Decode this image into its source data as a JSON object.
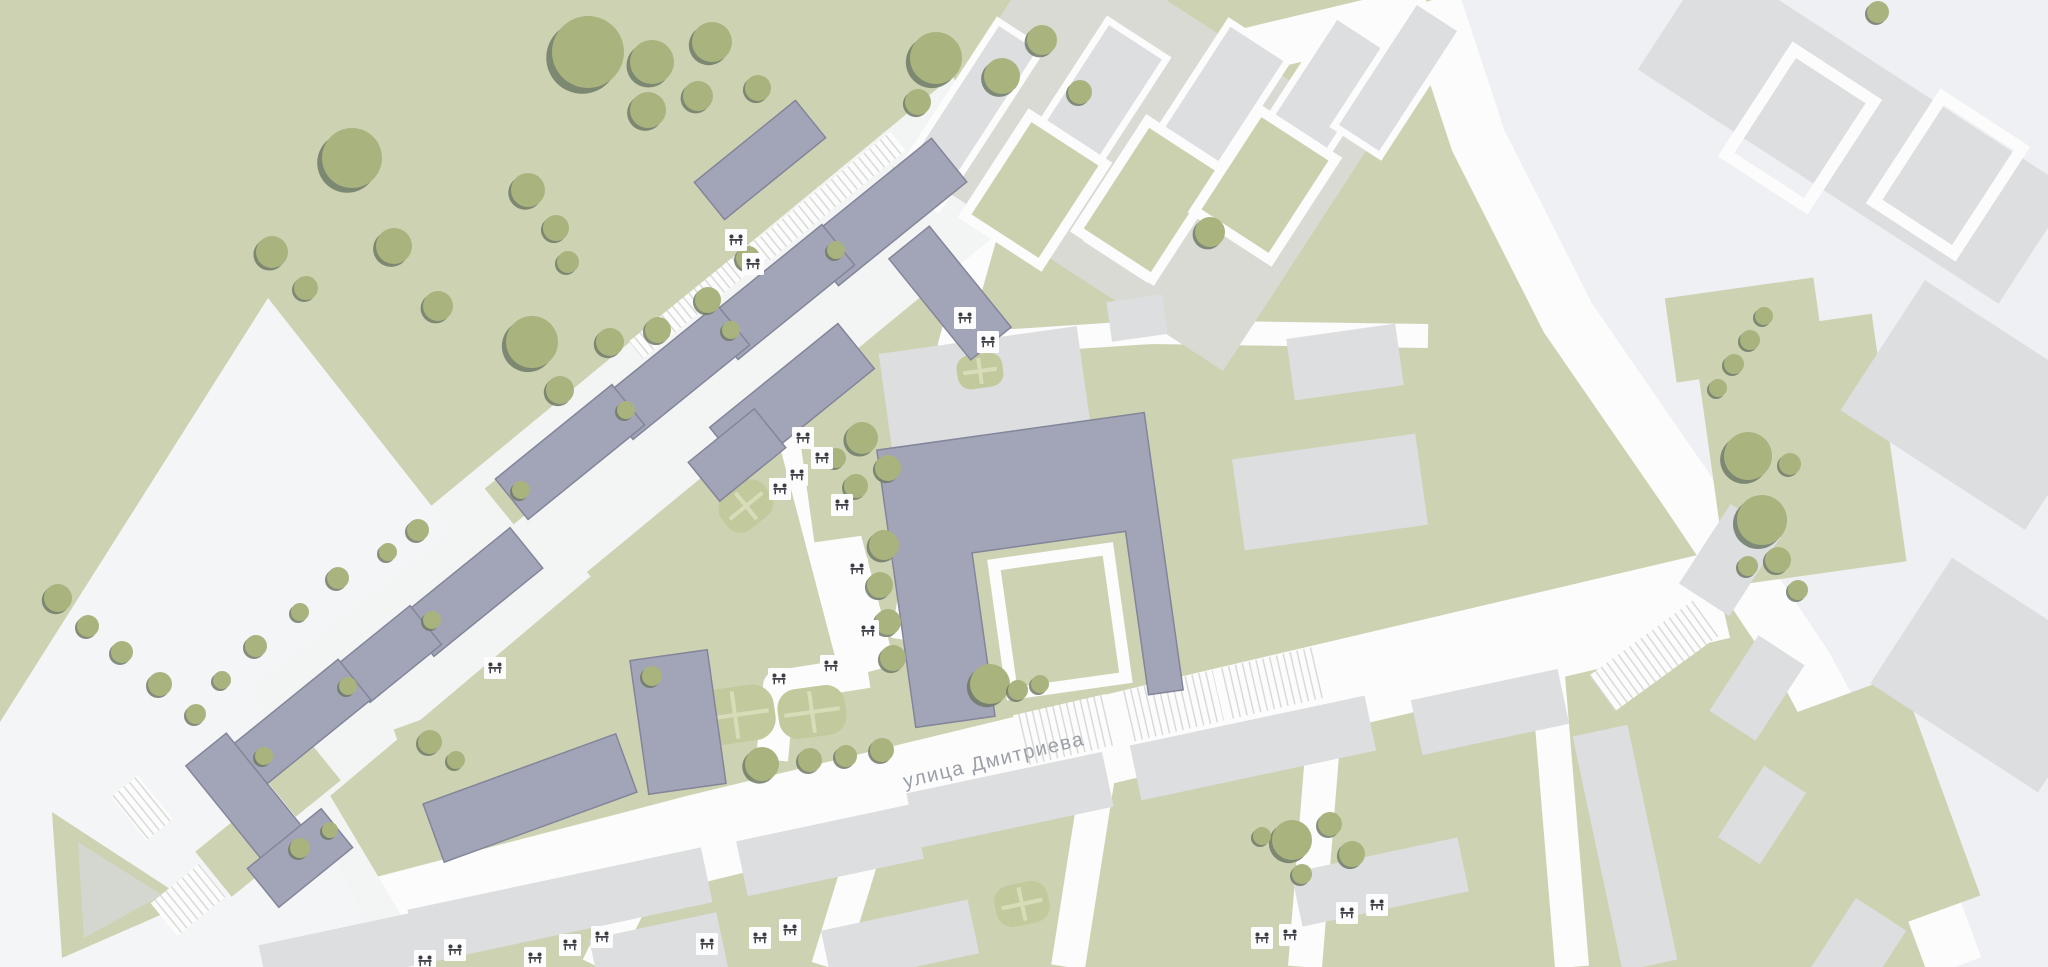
{
  "map": {
    "kind": "architectural masterplan site plan",
    "street_label": {
      "text": "улица Дмитриева"
    }
  },
  "icons": {
    "playground": "picnic-table-with-figures-icon",
    "tree": "tree-canopy-icon"
  },
  "palette": {
    "base-green": "#cdd3b2",
    "zone-light": "#eef0f3",
    "road-white": "#fbfcfb",
    "strip-white": "#f3f4f4",
    "plaza-white": "#f4f5f7",
    "building-new": "#a2a4b7",
    "building-new-outline": "#83859a",
    "building-context": "#dcdee0",
    "building-context-alt": "#d8dad3",
    "court-green": "#cbd1ae",
    "tree-green": "#a9b37e",
    "tree-shadow": "#6e7a66",
    "field-green": "#c2c99d",
    "field-line": "#d8dcb9",
    "stripe-gray": "#d3d6d2",
    "icon-ink": "#3c3f45",
    "triangle-gray": "#d4d6d0",
    "label-gray": "#9ba0a7"
  }
}
